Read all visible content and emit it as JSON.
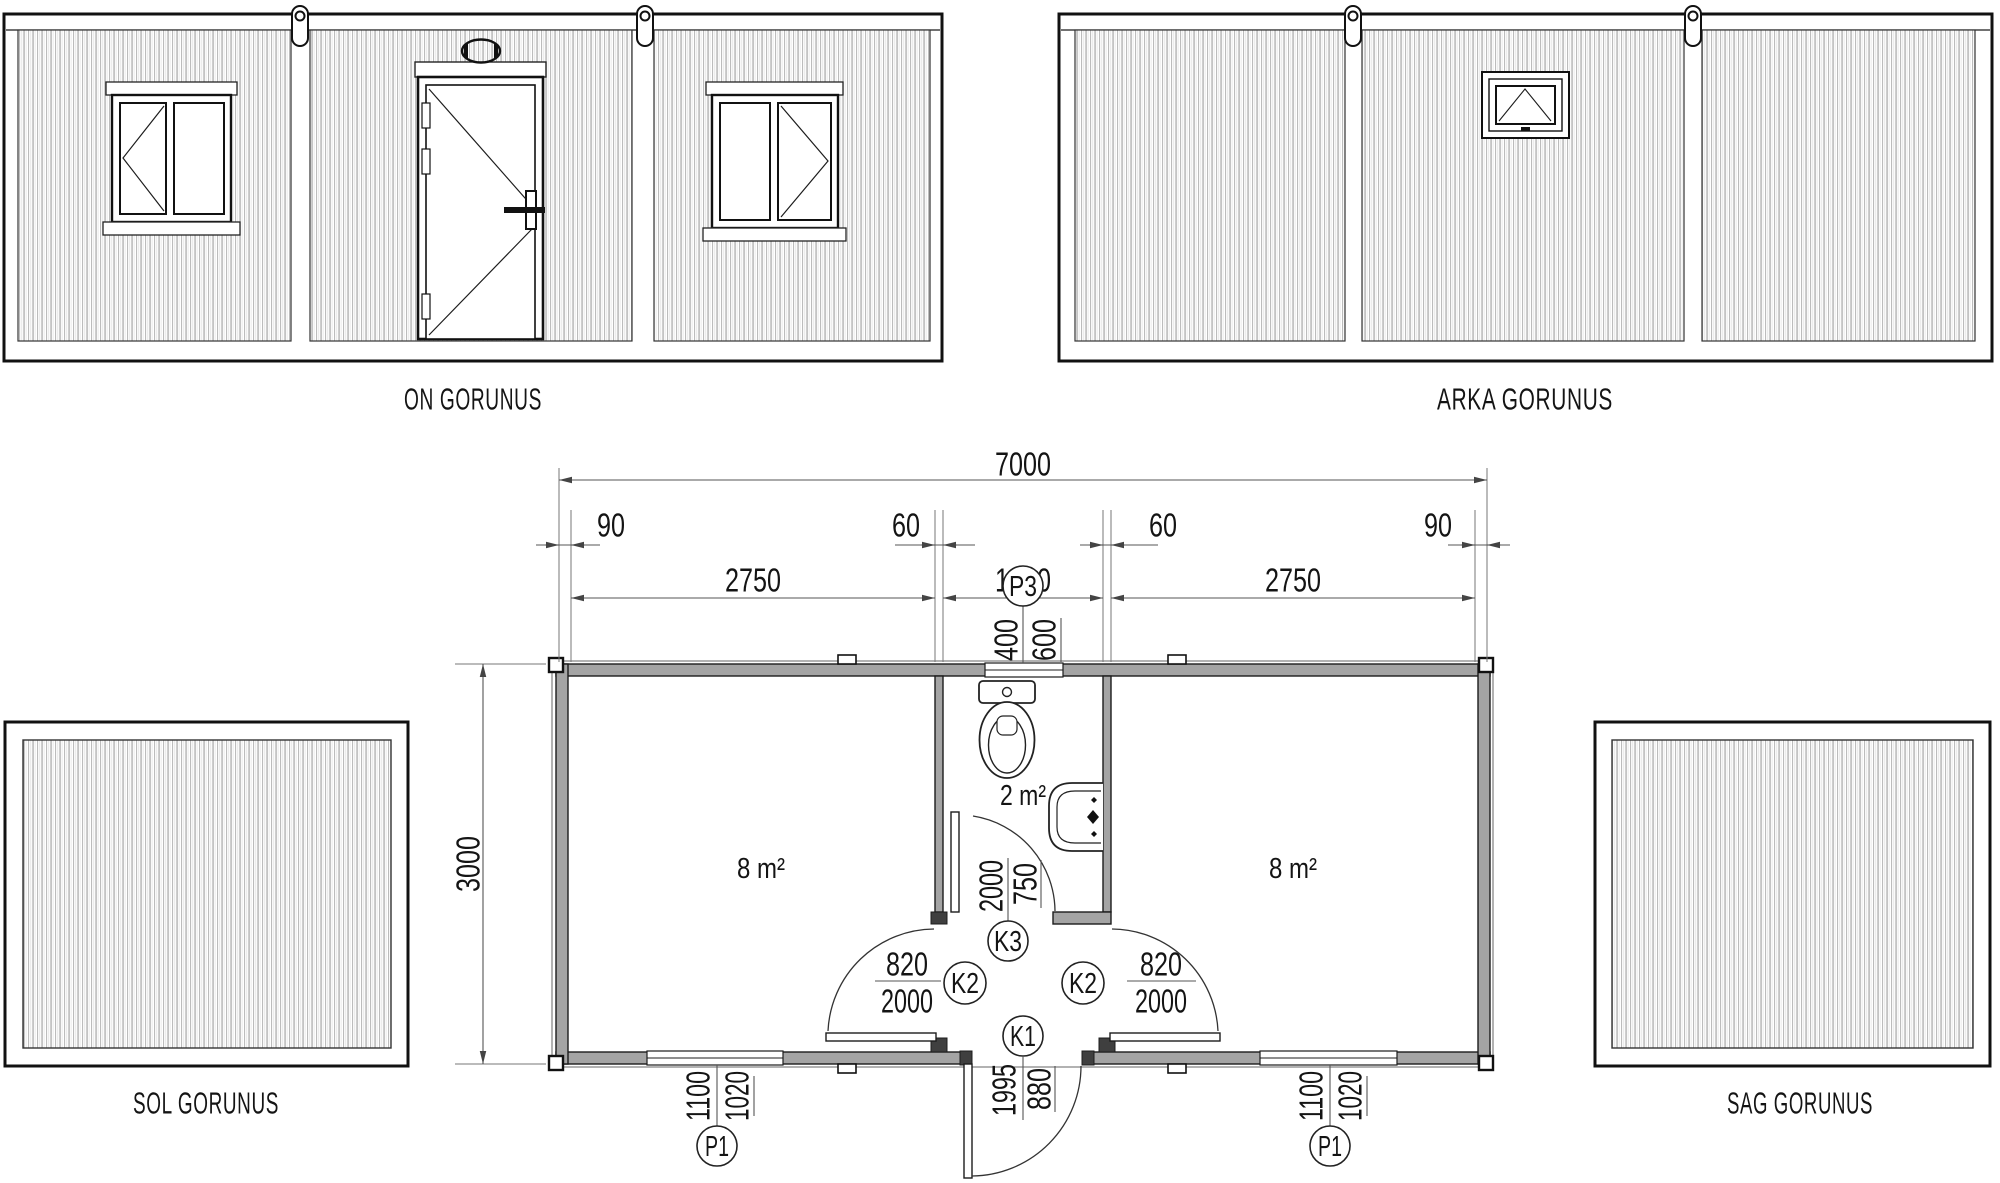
{
  "views": {
    "front": {
      "label": "ON GORUNUS"
    },
    "back": {
      "label": "ARKA GORUNUS"
    },
    "left": {
      "label": "SOL GORUNUS"
    },
    "right": {
      "label": "SAG GORUNUS"
    }
  },
  "plan": {
    "dims_top": {
      "total": "7000",
      "row2": [
        "90",
        "60",
        "60",
        "90"
      ],
      "row3": [
        "2750",
        "1200",
        "2750"
      ]
    },
    "dim_side": "3000",
    "rooms": {
      "left": "8 m²",
      "bath": "2 m²",
      "right": "8 m²"
    },
    "tags": {
      "p3": {
        "label": "P3",
        "dims": [
          "400",
          "600"
        ]
      },
      "k3": {
        "label": "K3",
        "dims": [
          "2000",
          "750"
        ]
      },
      "k2_left": {
        "label": "K2",
        "dims": [
          "820",
          "2000"
        ]
      },
      "k2_right": {
        "label": "K2",
        "dims": [
          "820",
          "2000"
        ]
      },
      "k1": {
        "label": "K1",
        "dims": [
          "1995",
          "880"
        ]
      },
      "p1_left": {
        "label": "P1",
        "dims": [
          "1100",
          "1020"
        ]
      },
      "p1_right": {
        "label": "P1",
        "dims": [
          "1100",
          "1020"
        ]
      }
    }
  }
}
